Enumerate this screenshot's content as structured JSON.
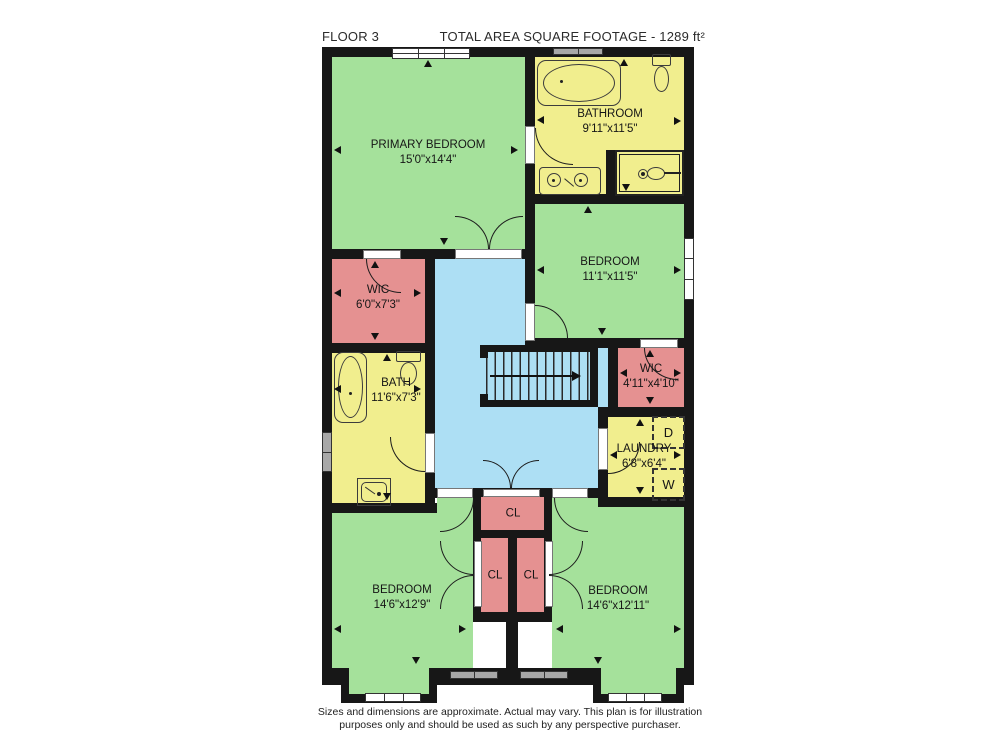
{
  "header": {
    "floor_label": "FLOOR 3",
    "total_area_label": "TOTAL AREA SQUARE FOOTAGE - 1289 ft²"
  },
  "rooms": {
    "primary_bedroom": {
      "name": "PRIMARY BEDROOM",
      "dimensions": "15'0\"x14'4\""
    },
    "bathroom": {
      "name": "BATHROOM",
      "dimensions": "9'11\"x11'5\""
    },
    "bedroom_upper": {
      "name": "BEDROOM",
      "dimensions": "11'1\"x11'5\""
    },
    "wic_left": {
      "name": "WIC",
      "dimensions": "6'0\"x7'3\""
    },
    "bath": {
      "name": "BATH",
      "dimensions": "11'6\"x7'3\""
    },
    "wic_right": {
      "name": "WIC",
      "dimensions": "4'11\"x4'10\""
    },
    "laundry": {
      "name": "LAUNDRY",
      "dimensions": "6'8\"x6'4\""
    },
    "closet_top": {
      "name": "CL"
    },
    "closet_left": {
      "name": "CL"
    },
    "closet_right": {
      "name": "CL"
    },
    "bedroom_bottom_left": {
      "name": "BEDROOM",
      "dimensions": "14'6\"x12'9\""
    },
    "bedroom_bottom_right": {
      "name": "BEDROOM",
      "dimensions": "14'6\"x12'11\""
    }
  },
  "appliances": {
    "dryer_label": "D",
    "washer_label": "W"
  },
  "footer": {
    "line1": "Sizes and dimensions are approximate. Actual may vary. This plan is for illustration",
    "line2": "purposes only and should be used as such by any perspective purchaser."
  },
  "colors": {
    "wall": "#171717",
    "bedroom": "#a5e19b",
    "bathroom": "#f1ee8e",
    "closet": "#e59191",
    "hallway": "#addff4",
    "window-white": "#ffffff",
    "window-gray": "#a8a8a8"
  },
  "icons": {
    "bathtub-icon": "rounded-rect-with-oval",
    "toilet-icon": "tank-and-bowl",
    "sink-icon": "basin-square",
    "double-sink-icon": "two-basins",
    "shower-icon": "sprayer-head",
    "stairs-icon": "treads-with-arrow",
    "door-arc-icon": "quarter-circle",
    "window-icon": "paned-bar",
    "dimension-marker-icon": "small-triangle"
  }
}
